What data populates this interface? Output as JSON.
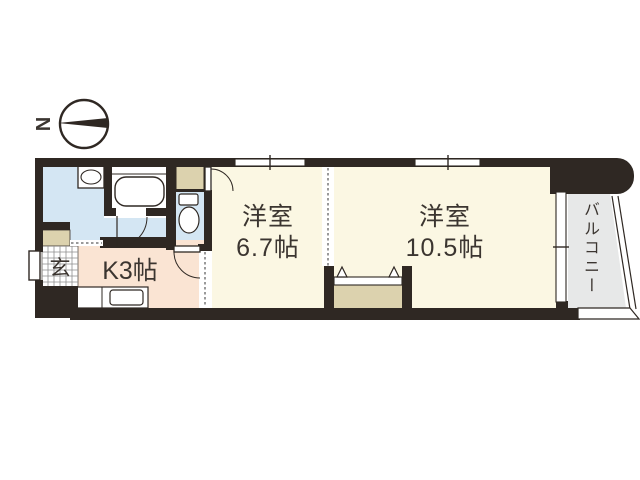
{
  "drawing_type": "apartment-floor-plan",
  "compass": {
    "north_label": "N"
  },
  "rooms": {
    "entrance": {
      "label": "玄"
    },
    "kitchen": {
      "label": "K3帖"
    },
    "western_room_small": {
      "name": "洋室",
      "area": "6.7帖"
    },
    "western_room_large": {
      "name": "洋室",
      "area": "10.5帖"
    },
    "balcony": {
      "label": "バルコニー"
    }
  },
  "icons": {
    "compass": "compass-north-needle",
    "bathtub": "bathtub",
    "toilet": "toilet",
    "washbasin": "washbasin-with-bowl",
    "kitchen_sink": "kitchen-counter-sink",
    "closet_doors": "folding-door-triangles",
    "entrance_tile": "tile-grid"
  },
  "colors": {
    "wall": "#2f2823",
    "room_floor": "#fbf7e3",
    "kitchen_floor": "#fae4d3",
    "wet_area_floor": "#d4e6f3",
    "closet": "#dcd2ae",
    "balcony_floor": "#e7e8e8",
    "background": "#ffffff",
    "text": "#3b3530"
  }
}
